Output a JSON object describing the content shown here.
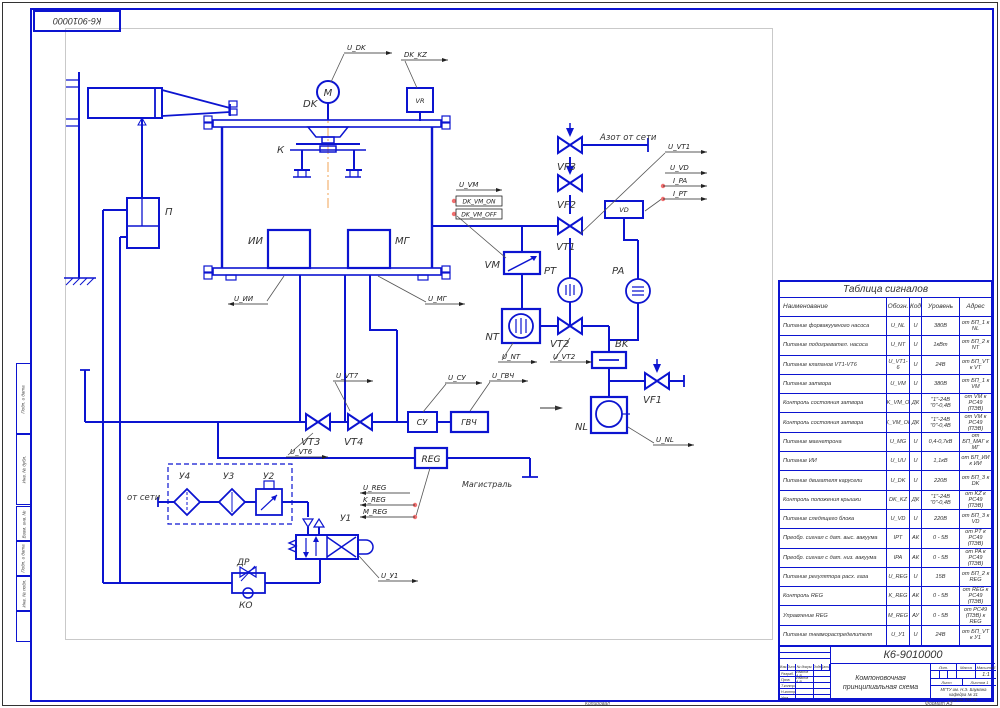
{
  "frame": {
    "corner_stamp": "К6-9010000",
    "side_stamps": [
      "Подп. и дата",
      "Инв. № дубл.",
      "Взам. инв. №",
      "Подп. и дата",
      "Инв. № подл.",
      ""
    ]
  },
  "schematic": {
    "labels": [
      {
        "id": "dk-label",
        "t": "DK",
        "x": 303,
        "y": 107,
        "fs": 10,
        "cls": "comp"
      },
      {
        "id": "motor-letter",
        "t": "M",
        "x": 328,
        "y": 96,
        "fs": 10,
        "cls": "comp",
        "a": "middle"
      },
      {
        "id": "k-label",
        "t": "К",
        "x": 277,
        "y": 153,
        "fs": 10,
        "cls": "comp"
      },
      {
        "id": "ii-label",
        "t": "ИИ",
        "x": 263,
        "y": 244,
        "fs": 10,
        "cls": "comp",
        "a": "end"
      },
      {
        "id": "mg-label",
        "t": "МГ",
        "x": 395,
        "y": 244,
        "fs": 10,
        "cls": "comp"
      },
      {
        "id": "p-label",
        "t": "П",
        "x": 165,
        "y": 215,
        "fs": 10,
        "cls": "comp"
      },
      {
        "id": "vm-label",
        "t": "VM",
        "x": 500,
        "y": 268,
        "fs": 10,
        "cls": "comp",
        "a": "end"
      },
      {
        "id": "vf3-label",
        "t": "VF3",
        "x": 557,
        "y": 170,
        "fs": 10,
        "cls": "comp"
      },
      {
        "id": "vf2-label",
        "t": "VF2",
        "x": 557,
        "y": 208,
        "fs": 10,
        "cls": "comp"
      },
      {
        "id": "vt1-label",
        "t": "VT1",
        "x": 556,
        "y": 250,
        "fs": 10,
        "cls": "comp"
      },
      {
        "id": "pt-label",
        "t": "PT",
        "x": 544,
        "y": 274,
        "fs": 10,
        "cls": "comp"
      },
      {
        "id": "pa-label",
        "t": "PA",
        "x": 612,
        "y": 274,
        "fs": 10,
        "cls": "comp"
      },
      {
        "id": "nt-label",
        "t": "NT",
        "x": 499,
        "y": 340,
        "fs": 10,
        "cls": "comp",
        "a": "end"
      },
      {
        "id": "vt2-label",
        "t": "VT2",
        "x": 550,
        "y": 347,
        "fs": 10,
        "cls": "comp"
      },
      {
        "id": "bk-label",
        "t": "BK",
        "x": 615,
        "y": 347,
        "fs": 10,
        "cls": "comp"
      },
      {
        "id": "vf1-label",
        "t": "VF1",
        "x": 643,
        "y": 403,
        "fs": 10,
        "cls": "comp"
      },
      {
        "id": "nl-label",
        "t": "NL",
        "x": 588,
        "y": 430,
        "fs": 10,
        "cls": "comp",
        "a": "end"
      },
      {
        "id": "vt3-label",
        "t": "VT3",
        "x": 301,
        "y": 445,
        "fs": 10,
        "cls": "comp"
      },
      {
        "id": "vt4-label",
        "t": "VT4",
        "x": 344,
        "y": 445,
        "fs": 10,
        "cls": "comp"
      },
      {
        "id": "y4-label",
        "t": "У4",
        "x": 179,
        "y": 479,
        "fs": 9,
        "cls": "comp"
      },
      {
        "id": "y3-label",
        "t": "У3",
        "x": 223,
        "y": 479,
        "fs": 9,
        "cls": "comp"
      },
      {
        "id": "y2-label",
        "t": "У2",
        "x": 263,
        "y": 479,
        "fs": 9,
        "cls": "comp"
      },
      {
        "id": "y1-label",
        "t": "У1",
        "x": 340,
        "y": 521,
        "fs": 9,
        "cls": "comp"
      },
      {
        "id": "dr-label",
        "t": "ДР",
        "x": 237,
        "y": 565,
        "fs": 9,
        "cls": "comp"
      },
      {
        "id": "ko-label",
        "t": "КО",
        "x": 239,
        "y": 608,
        "fs": 9,
        "cls": "comp"
      },
      {
        "id": "vr-text",
        "t": "VR",
        "x": 420,
        "y": 103,
        "fs": 6.5,
        "cls": "inbox",
        "a": "middle"
      },
      {
        "id": "vd-text",
        "t": "VD",
        "x": 624,
        "y": 212,
        "fs": 6.5,
        "cls": "inbox",
        "a": "middle"
      },
      {
        "id": "su-text",
        "t": "СУ",
        "x": 422,
        "y": 425,
        "fs": 8,
        "cls": "inbox",
        "a": "middle"
      },
      {
        "id": "gvch-text",
        "t": "ГВЧ",
        "x": 469,
        "y": 425,
        "fs": 8,
        "cls": "inbox",
        "a": "middle"
      },
      {
        "id": "reg-text",
        "t": "REG",
        "x": 431,
        "y": 462,
        "fs": 9,
        "cls": "inbox",
        "a": "middle"
      },
      {
        "id": "sig-u-dk",
        "t": "U_DK",
        "x": 347,
        "y": 50,
        "fs": 7,
        "cls": "sig",
        "ul": [
          344,
          392,
          53,
          "r"
        ]
      },
      {
        "id": "sig-dk-kz",
        "t": "DK_KZ",
        "x": 404,
        "y": 57,
        "fs": 7,
        "cls": "sig",
        "ul": [
          401,
          448,
          60,
          "r"
        ]
      },
      {
        "id": "ann-azot",
        "t": "Азот от сети",
        "x": 600,
        "y": 140,
        "fs": 8.5,
        "cls": "ann"
      },
      {
        "id": "sig-u-vt1",
        "t": "U_VT1",
        "x": 668,
        "y": 149,
        "fs": 7,
        "cls": "sig",
        "ul": [
          665,
          707,
          152,
          "r"
        ]
      },
      {
        "id": "sig-u-vd",
        "t": "U_VD",
        "x": 670,
        "y": 170,
        "fs": 7,
        "cls": "sig",
        "ul": [
          665,
          707,
          173,
          "r"
        ]
      },
      {
        "id": "sig-i-pa",
        "t": "I_PA",
        "x": 673,
        "y": 183,
        "fs": 7,
        "cls": "sig",
        "ul": [
          663,
          707,
          186,
          "r"
        ]
      },
      {
        "id": "sig-i-pt",
        "t": "I_PT",
        "x": 673,
        "y": 196,
        "fs": 7,
        "cls": "sig",
        "ul": [
          663,
          707,
          199,
          "r"
        ]
      },
      {
        "id": "sig-u-vm",
        "t": "U_VM",
        "x": 459,
        "y": 187,
        "fs": 7,
        "cls": "sig",
        "ul": [
          456,
          502,
          190,
          "r"
        ]
      },
      {
        "id": "sig-dk-vm-on",
        "t": "DK_VM_ON",
        "x": 479,
        "y": 203.5,
        "fs": 6,
        "cls": "sig",
        "a": "middle",
        "box": [
          456,
          196,
          46,
          10
        ]
      },
      {
        "id": "sig-dk-vm-off",
        "t": "DK_VM_OFF",
        "x": 479,
        "y": 216.5,
        "fs": 6,
        "cls": "sig",
        "a": "middle",
        "box": [
          456,
          209,
          46,
          10
        ]
      },
      {
        "id": "sig-u-ii",
        "t": "U_ИИ",
        "x": 234,
        "y": 301,
        "fs": 7,
        "cls": "sig",
        "ul": [
          228,
          268,
          304,
          "l"
        ]
      },
      {
        "id": "sig-u-mg",
        "t": "U_МГ",
        "x": 428,
        "y": 301,
        "fs": 7,
        "cls": "sig",
        "ul": [
          425,
          465,
          304,
          "r"
        ]
      },
      {
        "id": "sig-u-vt7",
        "t": "U_VT7",
        "x": 336,
        "y": 378,
        "fs": 7,
        "cls": "sig",
        "ul": [
          333,
          373,
          381,
          "r"
        ]
      },
      {
        "id": "sig-u-vt6",
        "t": "U_VT6",
        "x": 290,
        "y": 454,
        "fs": 7,
        "cls": "sig",
        "ul": [
          286,
          328,
          457,
          "r"
        ]
      },
      {
        "id": "sig-u-su",
        "t": "U_СУ",
        "x": 448,
        "y": 380,
        "fs": 7,
        "cls": "sig",
        "ul": [
          445,
          482,
          383,
          "r"
        ]
      },
      {
        "id": "sig-u-gvch",
        "t": "U_ГВЧ",
        "x": 492,
        "y": 378,
        "fs": 7,
        "cls": "sig",
        "ul": [
          489,
          528,
          381,
          "r"
        ]
      },
      {
        "id": "sig-u-nt",
        "t": "U_NT",
        "x": 502,
        "y": 359,
        "fs": 7,
        "cls": "sig",
        "ul": [
          498,
          537,
          362,
          "r"
        ]
      },
      {
        "id": "sig-u-vt2",
        "t": "U_VT2",
        "x": 553,
        "y": 359,
        "fs": 7,
        "cls": "sig",
        "ul": [
          550,
          592,
          362,
          "r"
        ]
      },
      {
        "id": "sig-u-nl",
        "t": "U_NL",
        "x": 656,
        "y": 442,
        "fs": 7,
        "cls": "sig",
        "ul": [
          653,
          694,
          445,
          "r"
        ]
      },
      {
        "id": "sig-u-reg",
        "t": "U_REG",
        "x": 363,
        "y": 490,
        "fs": 7,
        "cls": "sig",
        "ul": [
          360,
          410,
          493,
          "l"
        ]
      },
      {
        "id": "sig-k-reg",
        "t": "K_REG",
        "x": 363,
        "y": 502,
        "fs": 7,
        "cls": "sig",
        "ul": [
          360,
          415,
          505,
          "l"
        ]
      },
      {
        "id": "sig-m-reg",
        "t": "M_REG",
        "x": 363,
        "y": 514,
        "fs": 7,
        "cls": "sig",
        "ul": [
          360,
          415,
          517,
          "l"
        ]
      },
      {
        "id": "sig-u-y1",
        "t": "U_У1",
        "x": 381,
        "y": 578,
        "fs": 7,
        "cls": "sig",
        "ul": [
          378,
          418,
          581,
          "r"
        ]
      },
      {
        "id": "ann-ot-seti",
        "t": "от сети",
        "x": 127,
        "y": 500,
        "fs": 8.5,
        "cls": "ann"
      },
      {
        "id": "ann-magistral",
        "t": "Магистраль",
        "x": 462,
        "y": 487,
        "fs": 8,
        "cls": "ann"
      }
    ]
  },
  "signal_table": {
    "title": "Таблица сигналов",
    "columns": [
      "Наименование",
      "Обозн.",
      "Код",
      "Уровень",
      "Адрес"
    ],
    "rows": [
      [
        "Питание форвакуумного насоса",
        "U_NL",
        "U",
        "380В",
        "от БП_1 к NL"
      ],
      [
        "Питание подогревател. насоса",
        "U_NT",
        "U",
        "1кВт",
        "от БП_2 к NT"
      ],
      [
        "Питание клапанов VT1-VT6",
        "U_VT1-6",
        "U",
        "24В",
        "от БП_VT к VT"
      ],
      [
        "Питание затвора",
        "U_VM",
        "U",
        "380В",
        "от БП_1 к VM"
      ],
      [
        "Контроль состояния затвора",
        "DK_VM_ON",
        "ДК",
        "\"1\"-24В \"0\"-0,4В",
        "от VM к РС49 (ПЭВ)"
      ],
      [
        "Контроль состояния затвора",
        "DK_VM_OFF",
        "ДК",
        "\"1\"-24В \"0\"-0,4В",
        "от VM к РС49 (ПЭВ)"
      ],
      [
        "Питание магнетрона",
        "U_MG",
        "U",
        "0,4-0,7кВ",
        "от БП_МАГ к МГ"
      ],
      [
        "Питание ИИ",
        "U_UU",
        "U",
        "1,1кВ",
        "от БП_ИИ к ИИ"
      ],
      [
        "Питание двигателя карусели",
        "U_DK",
        "U",
        "220В",
        "от БП_3 к DK"
      ],
      [
        "Контроль положения крышки",
        "DK_KZ",
        "ДК",
        "\"1\"-24В \"0\"-0,4В",
        "от KZ к РС49 (ПЭВ)"
      ],
      [
        "Питание следящего блока",
        "U_VD",
        "U",
        "220В",
        "от БП_3 к VD"
      ],
      [
        "Преобр. сигнал с дат. выс. вакуума",
        "IPT",
        "АК",
        "0 - 5В",
        "от PT к РС49 (ПЭВ)"
      ],
      [
        "Преобр. сигнал с дат. низ. вакуума",
        "IPA",
        "АК",
        "0 - 5В",
        "от PA к РС49 (ПЭВ)"
      ],
      [
        "Питание регулятора расх. газа",
        "U_REG",
        "U",
        "15В",
        "от БП_2 к REG"
      ],
      [
        "Контроль REG",
        "K_REG",
        "АК",
        "0 - 5В",
        "от REG к РС49 (ПЭВ)"
      ],
      [
        "Управление REG",
        "M_REG",
        "АУ",
        "0 - 5В",
        "от РС49 (ПЭВ) к REG"
      ],
      [
        "Питание пневмораспределителя",
        "U_У1",
        "U",
        "24В",
        "от БП_VT к У1"
      ]
    ]
  },
  "title_block": {
    "number": "К6-9010000",
    "name_line1": "Компоновочная",
    "name_line2": "принципиальная схема",
    "sig_cols": [
      "Изм.",
      "Лист",
      "№ докум.",
      "Подп.",
      "Дата"
    ],
    "sig_rows": [
      {
        "role": "Разраб.",
        "name": "Иванов А.В."
      },
      {
        "role": "Пров.",
        "name": "Иванов А.В."
      },
      {
        "role": "Т.контр.",
        "name": ""
      },
      {
        "role": "Н.контр.",
        "name": ""
      },
      {
        "role": "Утв.",
        "name": ""
      }
    ],
    "lit_label": "Лит.",
    "mass_label": "Масса",
    "scale_label": "Масштаб",
    "scale_value": "1:1",
    "sheet_label": "Лист",
    "sheets_label": "Листов",
    "sheets_value": "1",
    "org_lines": [
      "МГТУ им. Н.Э. Баумана",
      "кафедра № 31",
      "группа ТМ-72"
    ]
  },
  "footer": {
    "copy": "Копировал",
    "format": "Формат А3"
  }
}
